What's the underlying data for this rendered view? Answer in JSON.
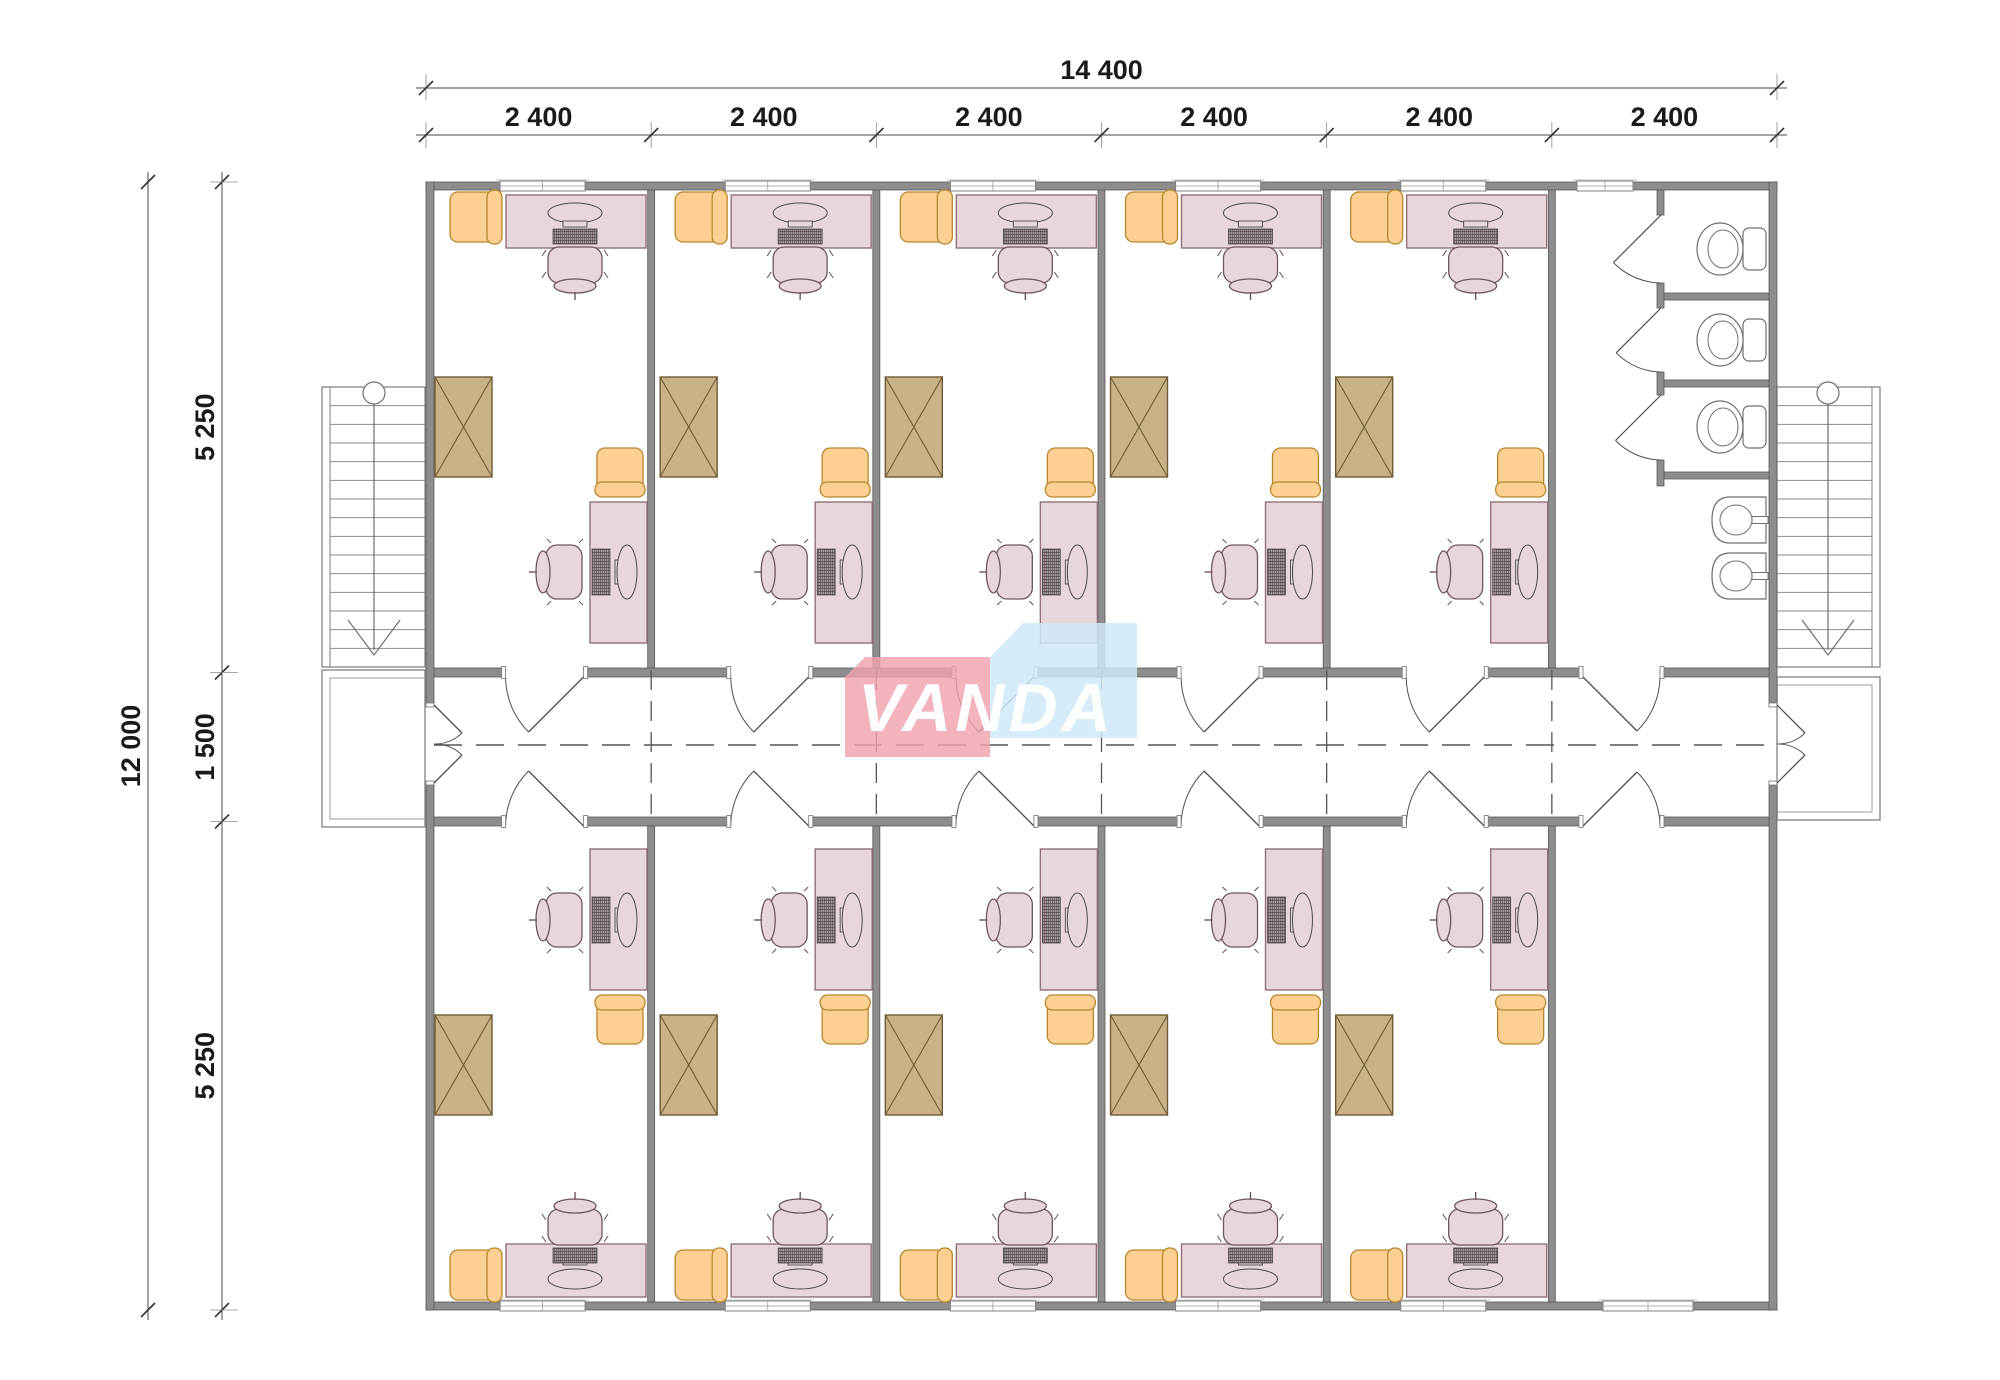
{
  "page": {
    "type": "architectural-floor-plan",
    "background": "#ffffff"
  },
  "logo": {
    "text": "VANDA",
    "left_segment": "VAN",
    "right_segment": "DA",
    "pink_block": "#efa2ae",
    "blue_block": "#cfe9f8",
    "text_color": "#ffffff"
  },
  "dimensions": {
    "top": {
      "total": "14 400",
      "bays": [
        "2 400",
        "2 400",
        "2 400",
        "2 400",
        "2 400",
        "2 400"
      ]
    },
    "left": {
      "total": "12 000",
      "segments": [
        "5 250",
        "1 500",
        "5 250"
      ]
    }
  },
  "colors": {
    "wall": "#8d8d8d",
    "wall_stroke": "#5a5a5a",
    "desk": "#e8d7da",
    "desk_stroke": "#8f7278",
    "chair": "#e8d7da",
    "chair_stroke": "#6d565c",
    "armchair": "#fbd092",
    "armchair_stroke": "#b8862d",
    "cabinet": "#c9b285",
    "cabinet_stroke": "#6e5b35",
    "fixture": "#ffffff",
    "fixture_stroke": "#6f6f6f",
    "line": "#6f6f6f",
    "door": "#4f4f4f",
    "dash": "#555555",
    "dim": "#1a1a1a",
    "dim_line": "#4a4a4a"
  },
  "plan": {
    "corridor": {
      "centerline": "dashed",
      "width_label": "1 500"
    },
    "stairs": [
      {
        "id": "stairs-left",
        "direction": "down"
      },
      {
        "id": "stairs-right",
        "direction": "down"
      }
    ],
    "entrances": [
      {
        "id": "entrance-left",
        "doors": 2
      },
      {
        "id": "entrance-right",
        "doors": 2
      }
    ],
    "rooms_top": [
      {
        "id": "office-top-1",
        "type": "office"
      },
      {
        "id": "office-top-2",
        "type": "office"
      },
      {
        "id": "office-top-3",
        "type": "office"
      },
      {
        "id": "office-top-4",
        "type": "office"
      },
      {
        "id": "office-top-5",
        "type": "office"
      },
      {
        "id": "washroom",
        "type": "washroom",
        "toilet_stalls": 3,
        "sinks": 2
      }
    ],
    "rooms_bottom": [
      {
        "id": "office-bottom-1",
        "type": "office"
      },
      {
        "id": "office-bottom-2",
        "type": "office"
      },
      {
        "id": "office-bottom-3",
        "type": "office"
      },
      {
        "id": "office-bottom-4",
        "type": "office"
      },
      {
        "id": "office-bottom-5",
        "type": "office"
      },
      {
        "id": "spare-room",
        "type": "empty"
      }
    ],
    "office_furniture": [
      "desk",
      "computer",
      "desk-chair",
      "armchair",
      "side-desk",
      "computer",
      "desk-chair",
      "armchair",
      "cabinet"
    ]
  }
}
